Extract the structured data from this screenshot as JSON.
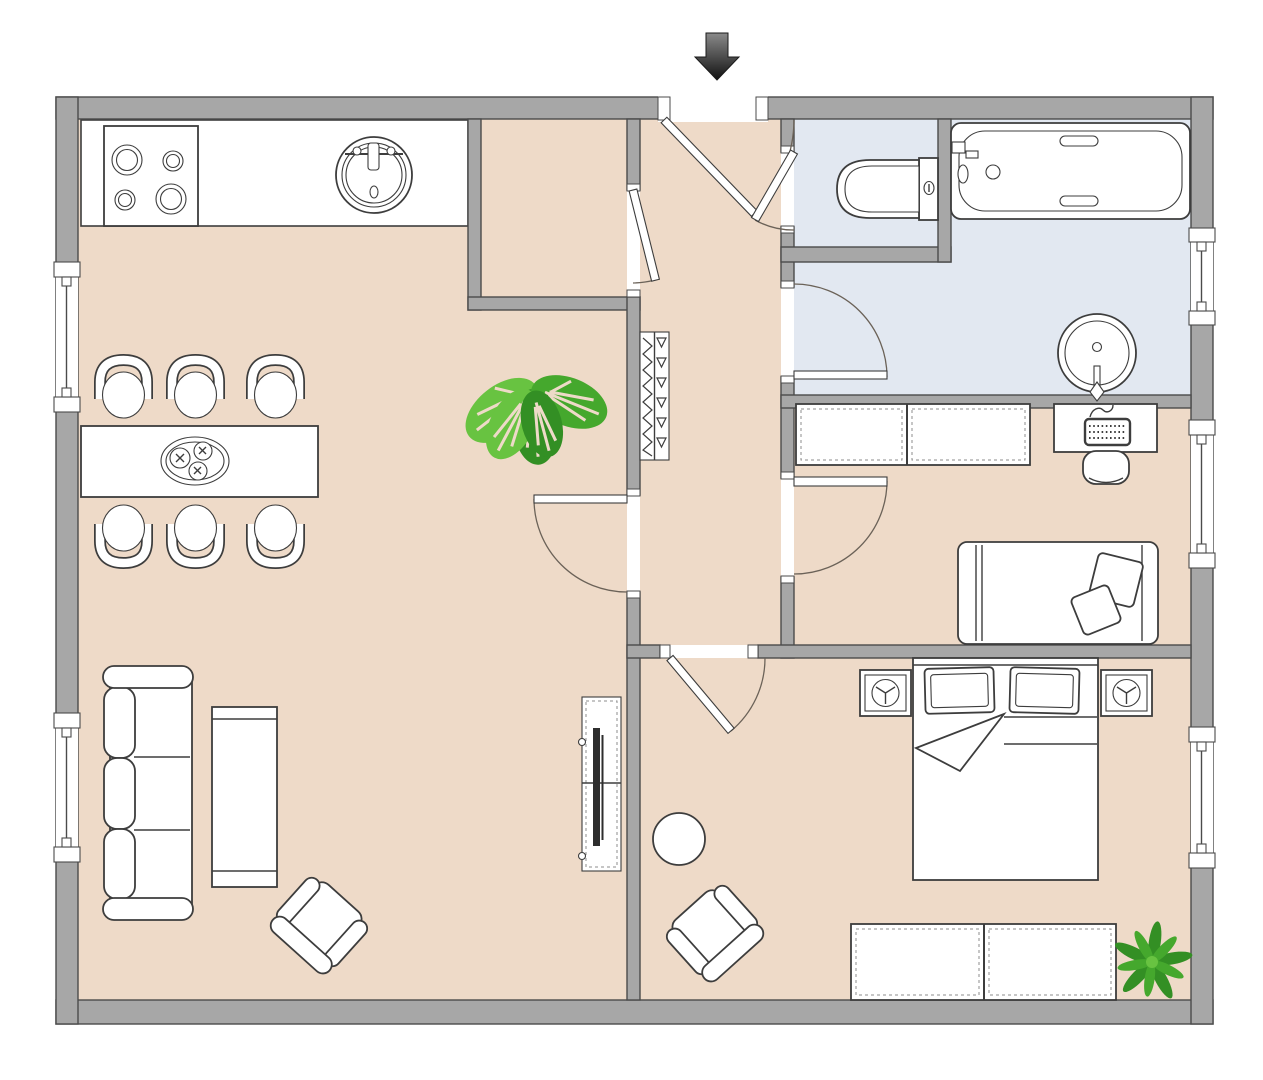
{
  "meta": {
    "kind": "apartment-floor-plan",
    "view": "top-down",
    "visible_text": "none"
  },
  "colors": {
    "wall": "#a7a7a7",
    "wall_line": "#4b4b4b",
    "floor": "#eedac8",
    "bath_floor": "#e2e8f1",
    "line": "#3d3d3d",
    "fill_white": "#ffffff",
    "dash": "#8e8e8e",
    "arc": "#6b6258",
    "tv_dark": "#2e2e2e",
    "plant_dark": "#338f24",
    "plant_mid": "#45a82d",
    "plant_light": "#68c341",
    "arrow_dark": "#111111",
    "arrow_light": "#8a8a8a"
  },
  "rooms": [
    {
      "id": "kitchen-living-dining",
      "floor": "beige"
    },
    {
      "id": "storage-nook",
      "floor": "beige"
    },
    {
      "id": "hallway",
      "floor": "beige"
    },
    {
      "id": "wc",
      "floor": "blue"
    },
    {
      "id": "bathroom",
      "floor": "blue"
    },
    {
      "id": "office-bedroom",
      "floor": "beige"
    },
    {
      "id": "bedroom",
      "floor": "beige"
    }
  ],
  "fixtures": {
    "entry": [
      "entry-arrow-icon",
      "entry-door"
    ],
    "kitchen": [
      "counter",
      "stove-4-burners-icon",
      "round-sink-icon"
    ],
    "dining": [
      "table",
      "six-chairs",
      "fruit-bowl-icon"
    ],
    "living": [
      "three-seat-sofa",
      "coffee-table",
      "armchair",
      "tv-cabinet",
      "monstera-plant-icon"
    ],
    "hallway": [
      "coat-wardrobe-zigzag-icon"
    ],
    "wc": [
      "toilet-icon"
    ],
    "bathroom": [
      "bathtub-icon",
      "washbasin-icon"
    ],
    "office": [
      "wardrobe-dashed",
      "desk",
      "keyboard-icon",
      "desk-chair",
      "single-bed",
      "two-pillows"
    ],
    "bedroom": [
      "double-bed",
      "two-pillows",
      "blanket-fold",
      "speaker-left-icon",
      "speaker-right-icon",
      "dresser-dashed",
      "round-side-table",
      "armchair",
      "palm-plant-icon"
    ]
  },
  "windows": {
    "left_wall": 2,
    "right_wall": 3
  },
  "doors": [
    "entry",
    "storage-nook",
    "living-room",
    "wc",
    "bathroom",
    "office",
    "bedroom"
  ]
}
